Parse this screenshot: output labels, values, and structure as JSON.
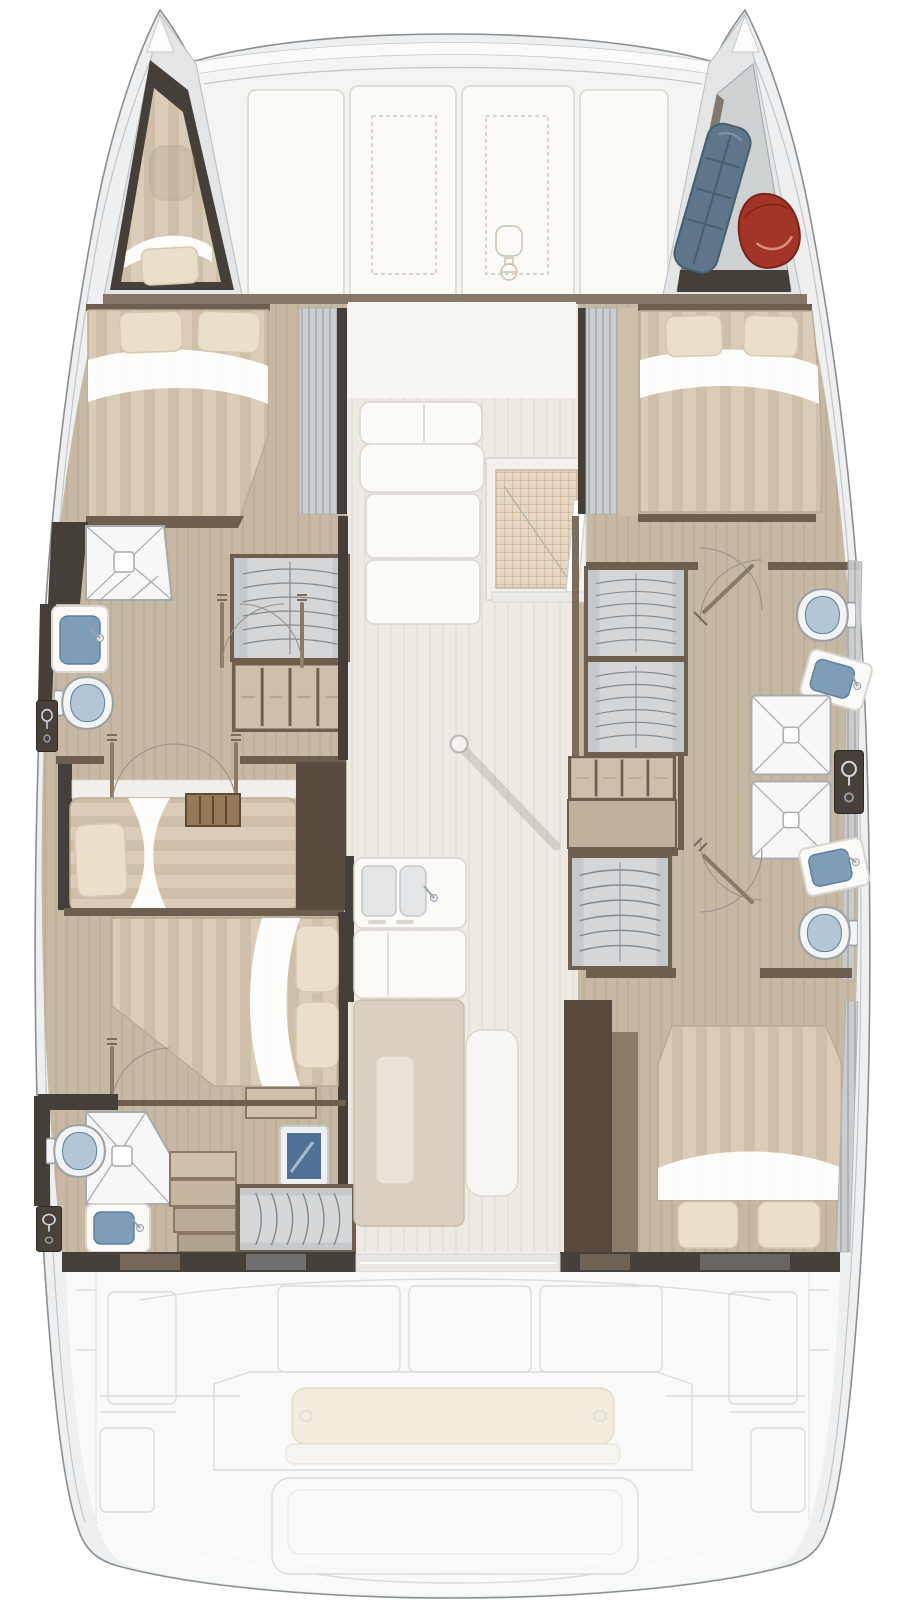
{
  "canvas": {
    "width": 920,
    "height": 1600
  },
  "image": {
    "kind": "yacht deck plan",
    "description": "Top-down interior floor plan of a four-cabin sailing catamaran: two hulls with cabins and bathrooms, central saloon with galley and table, foredeck lounge, bow lockers and ghosted aft cockpit with swim platform",
    "visible_text": []
  },
  "palette": {
    "page_bg": "#ffffff",
    "hull_line": "#898f93",
    "hull_inner": "#c2c5c7",
    "deck_rim": "#edeff0",
    "bow_deck": "#e3e5e6",
    "foredeck": "#f4f4f2",
    "panel_white": "#fbfaf7",
    "panel_line": "#d8d6cf",
    "hatch_dash": "#cfc8bc",
    "wall_dark": "#443f39",
    "wall_brown": "#6d5e4e",
    "wood_trim": "#8c7963",
    "floor_wood": "#c6b8a3",
    "floor_wood_line": "#b7a890",
    "floor_pale": "#edeae3",
    "floor_pale_line": "#e2ded5",
    "mattress": "#daccb7",
    "mattress_stripe": "#ccbba3",
    "pillow": "#eadfc9",
    "pillow_line": "#d6c9ae",
    "sheet": "#ffffff",
    "band_gray": "#cbcdcf",
    "band_gray_line": "#afb2b4",
    "wardrobe_gray": "#d4d6d7",
    "wardrobe_line": "#84888b",
    "fixture_white": "#f3f4f5",
    "fixture_line": "#9aa1a7",
    "basin_blue": "#7e9db9",
    "basin_blue_dark": "#5e81a0",
    "toilet_blue": "#b3c6d6",
    "shower_line": "#a7abae",
    "grid_mat": "#e6d7c3",
    "grid_line": "#c3a68e",
    "sail_blue": "#5d7689",
    "fender_red": "#a23527",
    "table_tan": "#d9d0c1",
    "table_leaf": "#e9e2d6",
    "bench_white": "#f7f6f2",
    "ghost_line": "#d9dbdc",
    "ghost_fill": "#f9fafa",
    "cushion_cream": "#f3ecdc",
    "tv_blue": "#4f7196",
    "ladder_wood": "#96785a"
  },
  "legend": {
    "rooms": [
      "foredeck-lounge",
      "port-bow-cabin",
      "starboard-bow-locker",
      "port-forward-cabin",
      "port-forward-bathroom",
      "port-mid-cabin",
      "port-aft-cabin",
      "port-aft-bathroom",
      "saloon",
      "galley",
      "starboard-forward-cabin",
      "starboard-forward-bathroom",
      "starboard-aft-bathroom",
      "starboard-aft-cabin",
      "aft-cockpit",
      "swim-platform"
    ],
    "furniture_icons": [
      "double-bed-icon",
      "single-bed-icon",
      "pillow-icon",
      "toilet-icon",
      "washbasin-icon",
      "shower-tray-icon",
      "shower-control-icon",
      "wardrobe-icon",
      "drawer-unit-icon",
      "stairs-icon",
      "ladder-icon",
      "sofa-icon",
      "galley-sink-icon",
      "dining-table-icon",
      "bench-icon",
      "entry-door-icon",
      "door-swing-icon",
      "mast-post-icon",
      "windlass-icon",
      "deck-hatch-icon",
      "sail-bag-icon",
      "fender-bag-icon",
      "tv-icon",
      "cockpit-bench-icon"
    ]
  }
}
